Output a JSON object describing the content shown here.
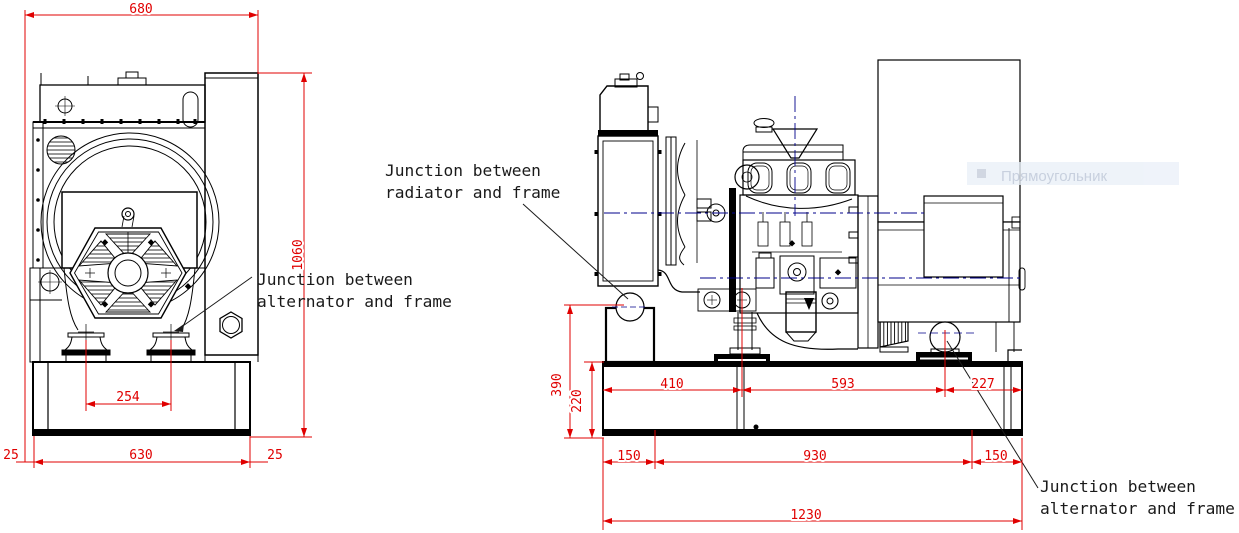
{
  "front_view": {
    "dims": {
      "overall_width": "680",
      "overall_height": "1060",
      "mount_spacing": "254",
      "left_margin": "25",
      "frame_length": "630",
      "right_margin": "25"
    }
  },
  "side_view": {
    "dims": {
      "radiator_junction_height": "390",
      "frame_height": "220",
      "front_mount_offset": "410",
      "engine_alternator_mount_spacing": "593",
      "rear_overhang": "227",
      "left_overhang": "150",
      "skid_mount_spacing": "930",
      "right_overhang": "150",
      "overall_length": "1230"
    }
  },
  "annotations": {
    "radiator_frame_line1": "Junction between",
    "radiator_frame_line2": "radiator and frame",
    "alternator_frame_line1": "Junction between",
    "alternator_frame_line2": "alternator and frame"
  },
  "overlay": {
    "tooltip_label": "Прямоугольник"
  },
  "colors": {
    "linework": "#000000",
    "dimension": "#e00000",
    "centerline": "#00008b",
    "tooltip_bg": "#eaf0f8",
    "tooltip_text": "#b9c4d6"
  }
}
